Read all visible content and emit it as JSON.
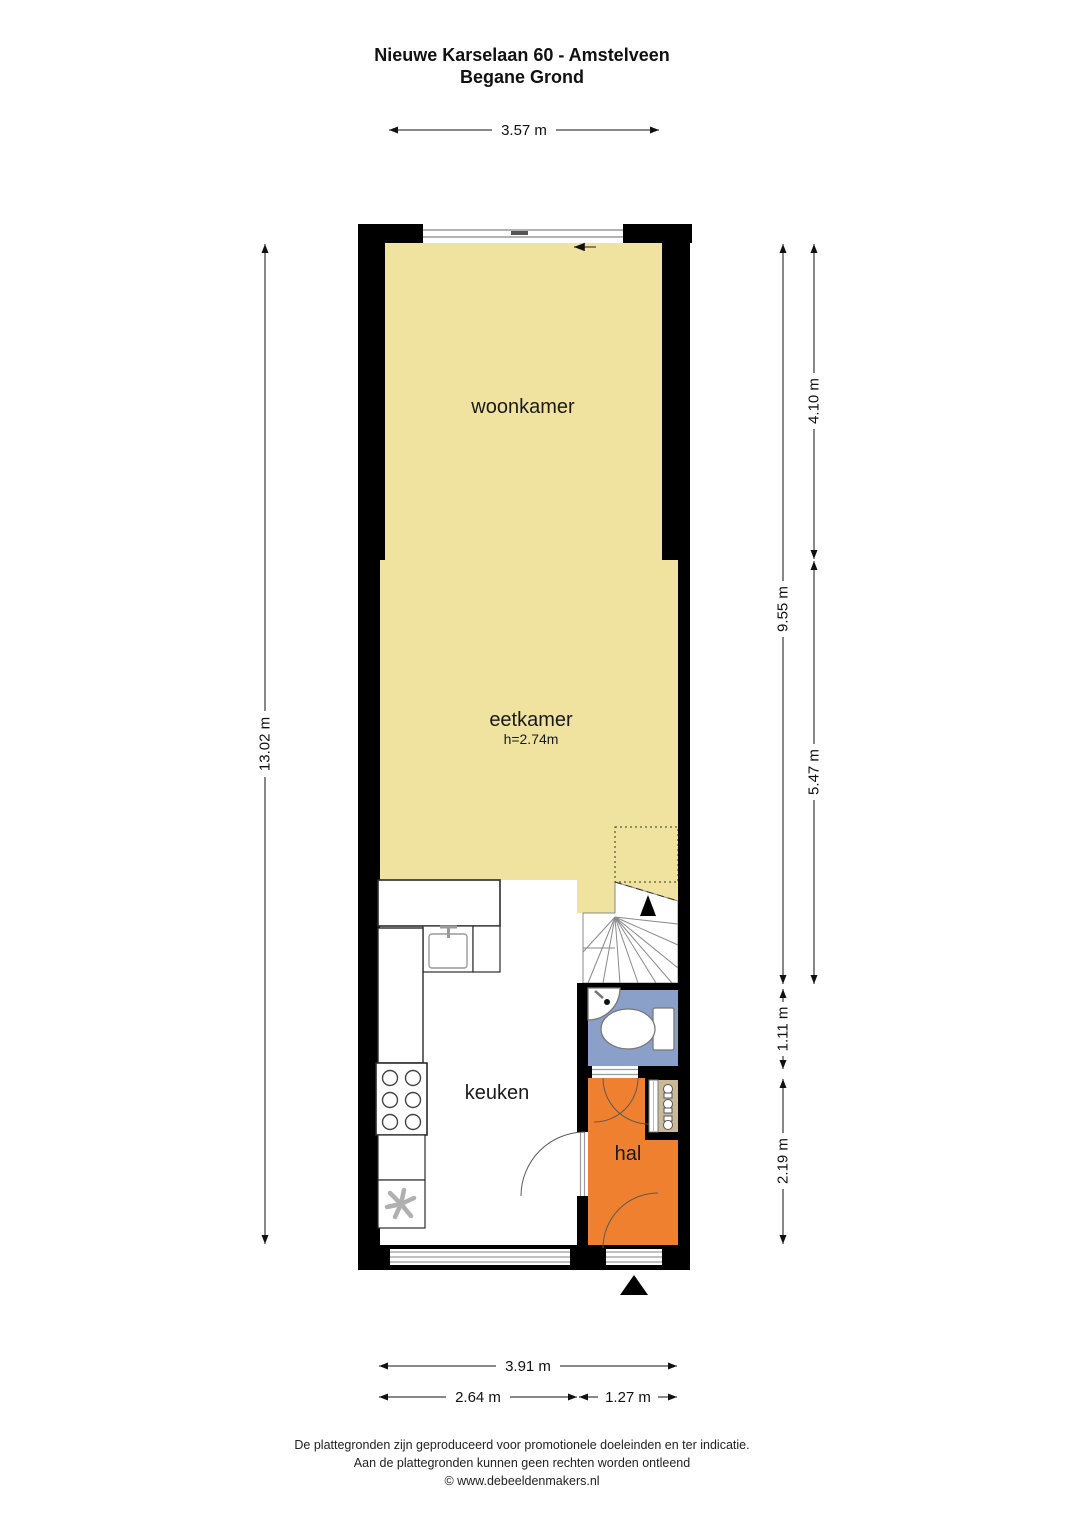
{
  "title": {
    "line1": "Nieuwe Karselaan 60 - Amstelveen",
    "line2": "Begane Grond"
  },
  "rooms": {
    "woonkamer": {
      "label": "woonkamer"
    },
    "eetkamer": {
      "label": "eetkamer",
      "ceiling_height": "h=2.74m"
    },
    "keuken": {
      "label": "keuken"
    },
    "hal": {
      "label": "hal"
    }
  },
  "dimensions": {
    "top_width": "3.57 m",
    "left_height": "13.02 m",
    "right_upper": "4.10 m",
    "right_lower": "5.47 m",
    "right_total": "9.55 m",
    "right_toilet": "1.11 m",
    "right_hal": "2.19 m",
    "bottom_total": "3.91 m",
    "bottom_keuken": "2.64 m",
    "bottom_hal": "1.27 m"
  },
  "icons": {
    "entrance_arrow": "▲",
    "stairs_direction_arrow": "▲",
    "window_slide_arrow": "←"
  },
  "palette": {
    "room_yellow": "#f0e3a0",
    "hal_orange": "#ef8030",
    "toilet_blue": "#8ba0c9",
    "meterkast_tan": "#c9ba97",
    "wall_black": "#000000"
  },
  "footer": {
    "line1": "De plattegronden zijn geproduceerd voor promotionele doeleinden en ter indicatie.",
    "line2": "Aan de plattegronden kunnen geen rechten worden ontleend",
    "line3": "© www.debeeldenmakers.nl"
  }
}
